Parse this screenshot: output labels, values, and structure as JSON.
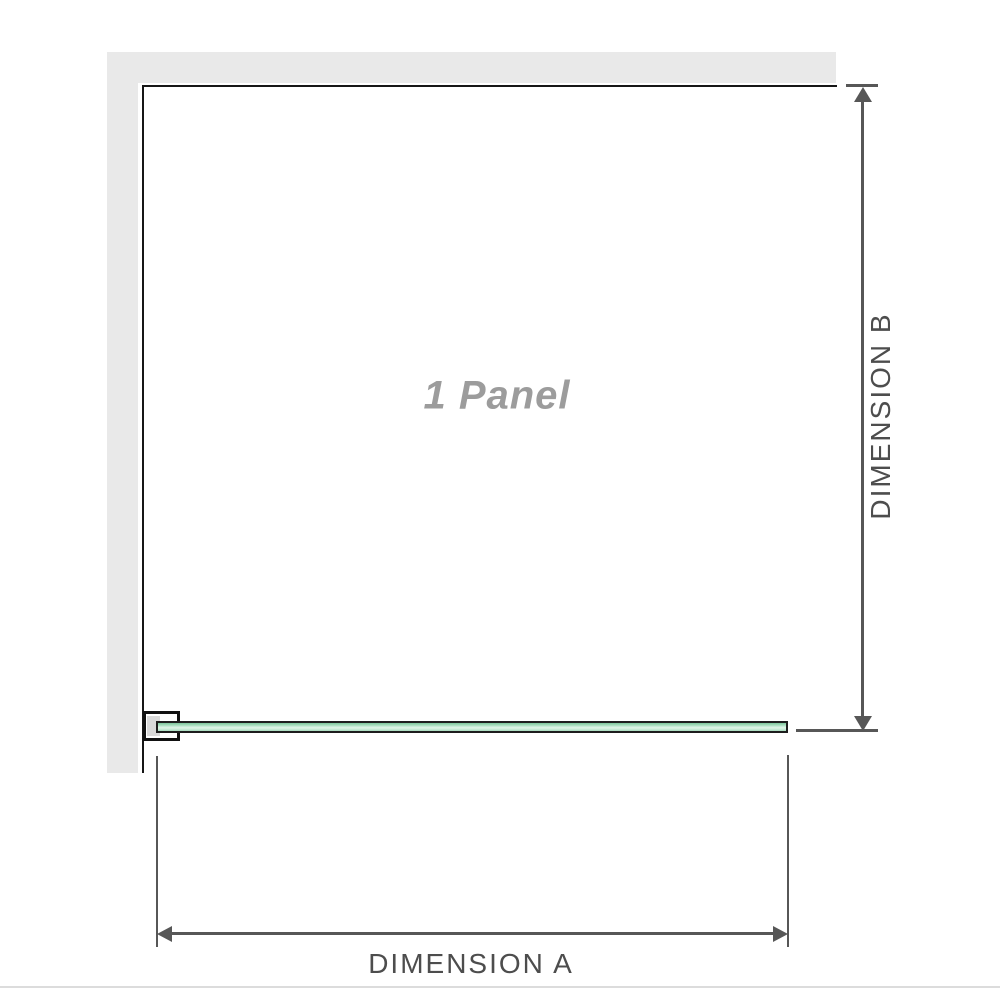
{
  "diagram": {
    "title": "shower-panel-dimension-diagram",
    "panel_label": "1 Panel",
    "dimension_a_label": "DIMENSION A",
    "dimension_b_label": "DIMENSION B"
  },
  "colors": {
    "background": "#ffffff",
    "wall": "#e9e9e9",
    "panel_edge": "#161616",
    "dimension_line": "#575757",
    "dimension_text": "#4d4d4d",
    "panel_label_text": "#9c9c9c",
    "glass_border": "#1d1d1d",
    "glass_green_dark": "#7cc49a",
    "glass_green_light": "#def3e7",
    "bracket_pad": "#d9d9d9",
    "separator": "#dcdcdc"
  },
  "icons": [
    "arrow-up-icon",
    "arrow-down-icon",
    "arrow-left-icon",
    "arrow-right-icon"
  ]
}
